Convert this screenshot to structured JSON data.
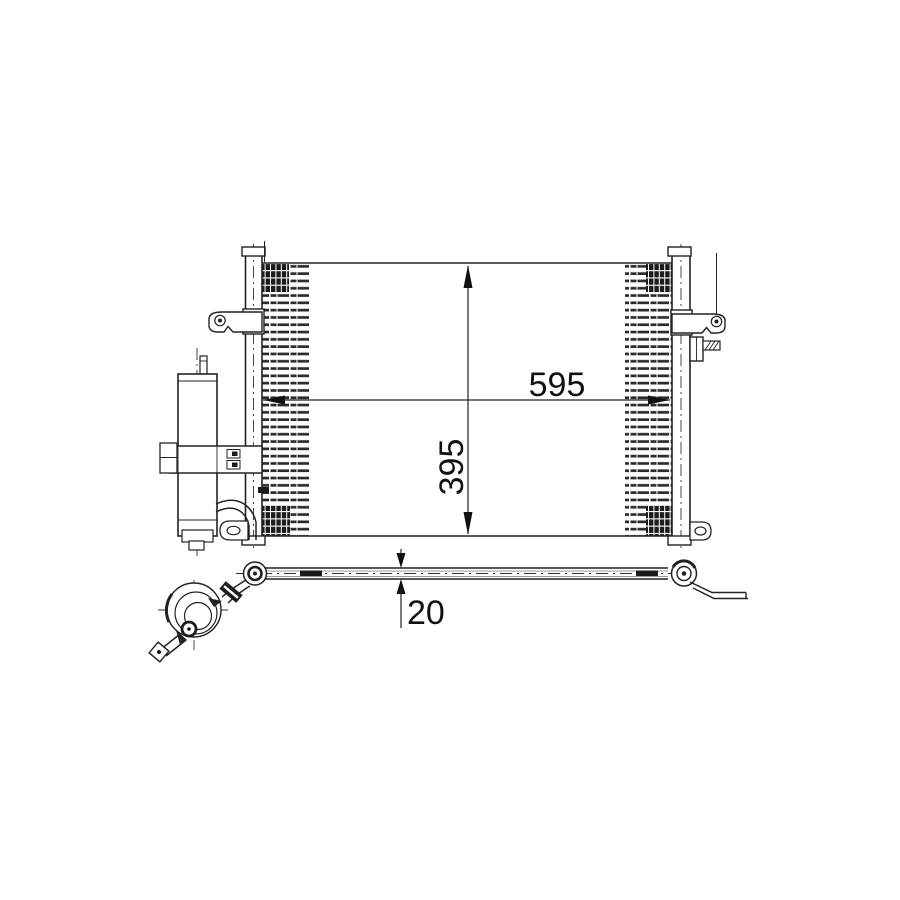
{
  "page": {
    "background": "#ffffff"
  },
  "drawing": {
    "type": "technical-diagram",
    "subject": "AC condenser with receiver drier - front view and top view",
    "line_color": "#222222",
    "text_color": "#111111",
    "dimensions": {
      "width_mm": "595",
      "height_mm": "395",
      "depth_mm": "20"
    }
  }
}
